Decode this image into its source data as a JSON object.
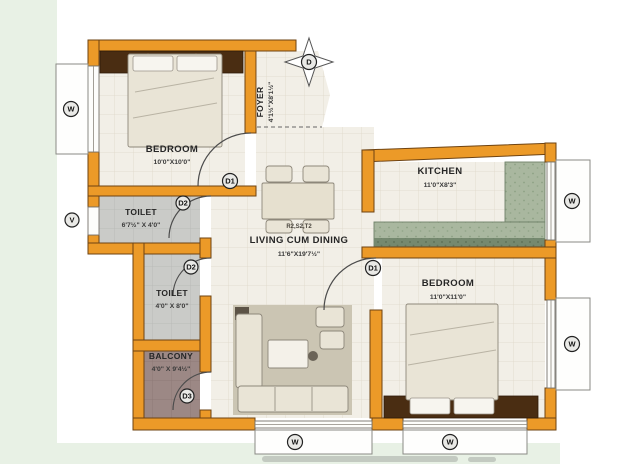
{
  "plan": {
    "rooms": {
      "bedroom1": {
        "name": "BEDROOM",
        "dims": "10'0\"X10'0\""
      },
      "foyer": {
        "name": "FOYER",
        "dims": "4'1½\"X8'1½\""
      },
      "kitchen": {
        "name": "KITCHEN",
        "dims": "11'0\"X8'3\""
      },
      "living": {
        "name": "LIVING CUM DINING",
        "dims": "11'6\"X19'7½\"",
        "furniture_code": "R2,S2,T2"
      },
      "bedroom2": {
        "name": "BEDROOM",
        "dims": "11'0\"X11'0\""
      },
      "toilet1": {
        "name": "TOILET",
        "dims": "6'7½\" X 4'0\""
      },
      "toilet2": {
        "name": "TOILET",
        "dims": "4'0\" X 8'0\""
      },
      "balcony": {
        "name": "BALCONY",
        "dims": "4'0\" X 9'4½\""
      }
    },
    "markers": {
      "window": "W",
      "ventilator": "V",
      "main_door": "D",
      "bedroom_door": "D1",
      "toilet_door": "D2",
      "balcony_door": "D3"
    },
    "colors": {
      "wall": "#EC9A28",
      "wall_outline": "#6E4312",
      "floor": "#F2EFE7",
      "tile_line": "#DFD8C9",
      "toilet_floor": "#CACBC8",
      "balcony_floor": "#9C8885",
      "kitchen_counter": "#A9B79F",
      "kitchen_counter_dark": "#75896F",
      "wood_furniture": "#4A2D12",
      "page_tint": "#E8F1E5"
    }
  }
}
